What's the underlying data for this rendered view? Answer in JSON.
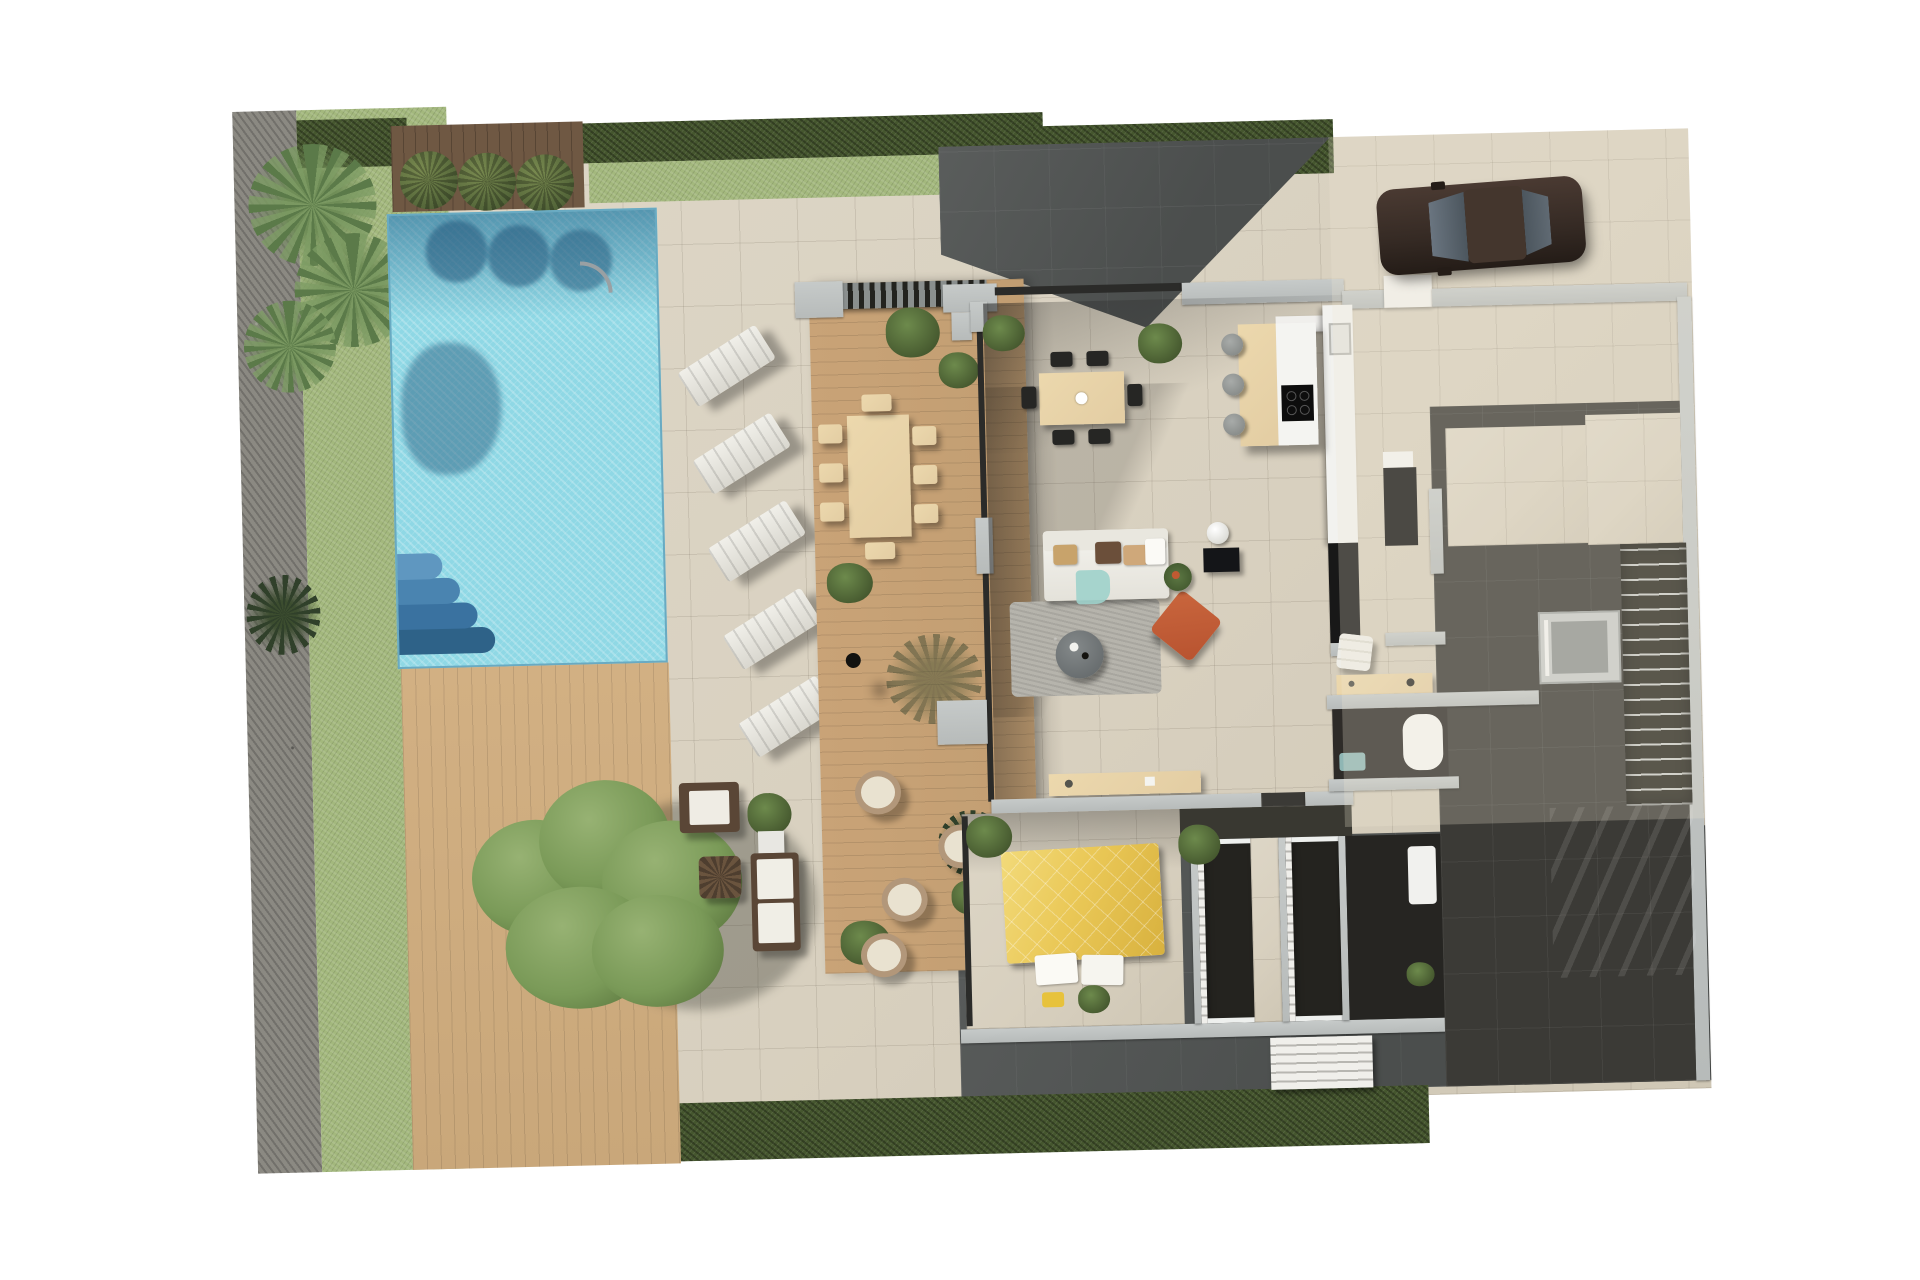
{
  "scene": {
    "description": "Top-down 3D rendered ground-floor site plan of a modern villa: garden with palms, swimming pool, sun deck, covered wooden terrace, open-plan living-dining-kitchen, bedroom suite with walk-in closets, bathrooms, elevator and staircase core, driveway with parked car",
    "visible_text": "none"
  },
  "palette": {
    "bg": "#ffffff",
    "stone": "#d8d0bf",
    "stoneLine": "rgba(90,80,65,0.14)",
    "grass": "#a3b87d",
    "hedge": "#45562e",
    "gravel": "#8b8982",
    "deckWood": "#c9a77a",
    "terraceWood": "#c29e72",
    "planter": "#6f5843",
    "pool": "#8fd8e5",
    "poolShadow": "#2e6288",
    "wall": "#b7bbba",
    "charcoal": "#3b3a36",
    "darkPaving": "#4b4e4d",
    "whiteFurniture": "#f1efe9",
    "lightWood": "#e3cda3",
    "bedYellow": "#eac857",
    "accentOrange": "#b85330",
    "accentTeal": "#9fd2cb",
    "carBody": "#352a24",
    "treeGreen": "#7a9a58"
  },
  "inventory": {
    "garden": {
      "palm_clusters": 3,
      "round_bushes": 3,
      "large_tree": 1,
      "gravel_border": 1,
      "hedges": 3
    },
    "pool_area": {
      "pool": 1,
      "pool_steps": 1,
      "sun_loungers": 5,
      "outdoor_shower": 1
    },
    "outdoor_lounge": {
      "armchair": 1,
      "l_sofa": 1,
      "wicker_table": 1,
      "planter_box": 1
    },
    "wood_terrace": {
      "pergola": 1,
      "dining_table": 1,
      "dining_chairs": 8,
      "rattan_chairs": 4,
      "plants": 6
    },
    "living_area": {
      "sofa": 1,
      "rug": 1,
      "coffee_table": 1,
      "floor_cushion": 1,
      "floor_lamp": 1,
      "side_table": 1,
      "pouf": 1,
      "console": 1,
      "desk": 1,
      "dining_table": 1,
      "dining_chairs": 6
    },
    "kitchen": {
      "island": 1,
      "bar_stools": 3,
      "cooktop": 1,
      "counter": 1,
      "tall_black_unit": 1
    },
    "bedroom": {
      "double_bed": 1,
      "pillows": 2,
      "walk_in_closets": 2,
      "plants": 2
    },
    "bathrooms": {
      "count": 2,
      "bathtub": 1,
      "sinks": 2
    },
    "circulation": {
      "elevator": 1,
      "interior_staircase": 1,
      "exterior_staircase": 1,
      "entry_door": 1
    },
    "driveway": {
      "car": 1
    }
  }
}
